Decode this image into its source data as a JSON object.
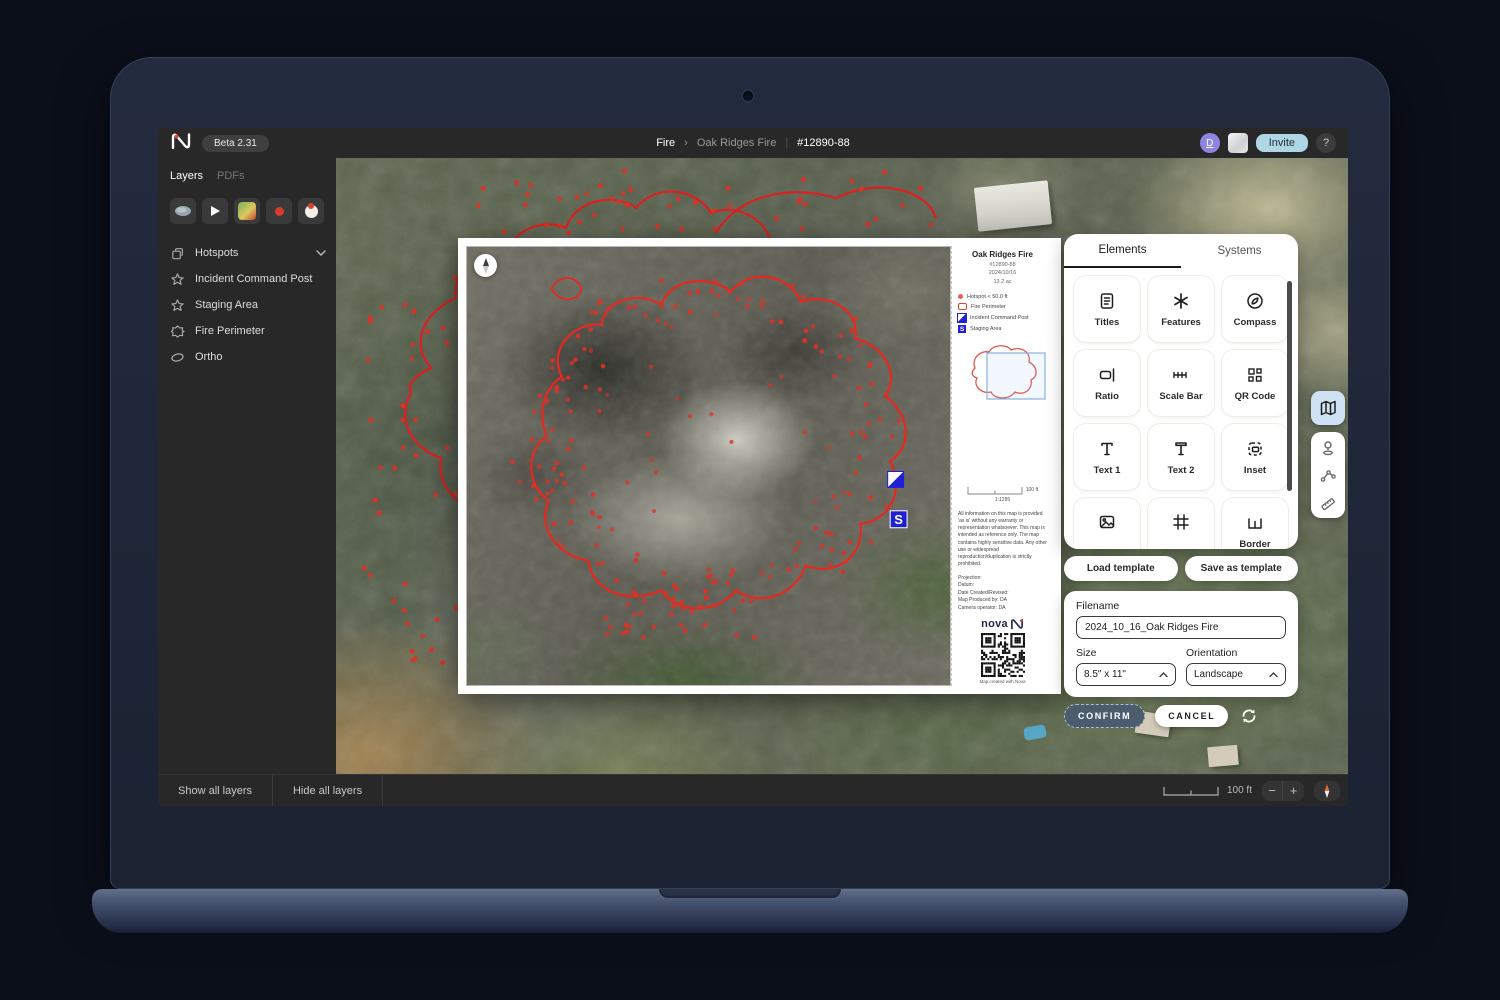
{
  "topbar": {
    "beta_badge": "Beta 2.31",
    "breadcrumb": {
      "section": "Fire",
      "separator": "›",
      "item": "Oak Ridges Fire",
      "divider": "|",
      "incident_id": "#12890-88"
    },
    "avatar_initial": "D",
    "invite_label": "Invite",
    "help_label": "?"
  },
  "sidebar": {
    "tabs": [
      {
        "label": "Layers",
        "active": true
      },
      {
        "label": "PDFs",
        "active": false
      }
    ],
    "tool_icons": [
      "stone-icon",
      "play-icon",
      "image-icon",
      "red-dot-icon",
      "hotspot-cluster-icon"
    ],
    "layers": [
      {
        "label": "Hotspots",
        "icon": "layers-copy-icon",
        "expandable": true
      },
      {
        "label": "Incident Command Post",
        "icon": "star-icon"
      },
      {
        "label": "Staging Area",
        "icon": "star-icon"
      },
      {
        "label": "Fire Perimeter",
        "icon": "polygon-icon"
      },
      {
        "label": "Ortho",
        "icon": "ellipse-icon"
      }
    ]
  },
  "paper": {
    "title": "Oak Ridges Fire",
    "incident_id": "#12890-88",
    "date": "2024/10/16",
    "area": "13.2 ac",
    "legend": [
      {
        "symbol": "hotspot-dot",
        "label": "Hotspot < 50.0 ft"
      },
      {
        "symbol": "fire-perimeter",
        "label": "Fire Perimeter"
      },
      {
        "symbol": "incident-command-post",
        "label": "Incident Command Post"
      },
      {
        "symbol": "staging-area",
        "label": "Staging Area"
      }
    ],
    "staging_letter": "S",
    "scale_label": "100 ft",
    "scale_ratio": "1:1285",
    "disclaimer": "All information on this map is provided 'as is' without any warranty or representation whatsoever. This map is intended as reference only. The map contains highly sensitive data. Any other use or widespread reproduction/duplication is strictly prohibited.",
    "credits": [
      "Projection:",
      "Datum:",
      "Date Created/Revised:",
      "Map Produced by: DA",
      "Camera operator: DA"
    ],
    "brand": "nova",
    "qr_caption": "Map created with Nova"
  },
  "elements_panel": {
    "tabs": [
      {
        "label": "Elements",
        "active": true
      },
      {
        "label": "Systems",
        "active": false
      }
    ],
    "items": [
      {
        "label": "Titles",
        "icon": "titles-icon"
      },
      {
        "label": "Features",
        "icon": "features-icon"
      },
      {
        "label": "Compass",
        "icon": "compass-icon"
      },
      {
        "label": "Ratio",
        "icon": "ratio-icon"
      },
      {
        "label": "Scale Bar",
        "icon": "scalebar-icon"
      },
      {
        "label": "QR Code",
        "icon": "qrcode-icon"
      },
      {
        "label": "Text 1",
        "icon": "text1-icon"
      },
      {
        "label": "Text 2",
        "icon": "text2-icon"
      },
      {
        "label": "Inset",
        "icon": "inset-icon"
      },
      {
        "label": "",
        "icon": "image-icon"
      },
      {
        "label": "",
        "icon": "grid-icon"
      },
      {
        "label": "Border",
        "icon": "border-icon"
      }
    ]
  },
  "template_buttons": {
    "load": "Load template",
    "save": "Save as template"
  },
  "export_form": {
    "filename_label": "Filename",
    "filename_value": "2024_10_16_Oak Ridges Fire",
    "size_label": "Size",
    "size_value": "8.5\" x 11\"",
    "orientation_label": "Orientation",
    "orientation_value": "Landscape",
    "confirm_label": "CONFIRM",
    "cancel_label": "CANCEL"
  },
  "statusbar": {
    "show_all": "Show all layers",
    "hide_all": "Hide all layers",
    "scale_label": "100 ft",
    "zoom_out": "−",
    "zoom_in": "+"
  },
  "colors": {
    "accent_red": "#e0442e",
    "invite_blue": "#aed6e4",
    "avatar_purple": "#8e85e0",
    "confirm_slate": "#4b5d6d",
    "marker_blue": "#1f1fd4",
    "tool_active_blue": "#cfe2f3"
  }
}
